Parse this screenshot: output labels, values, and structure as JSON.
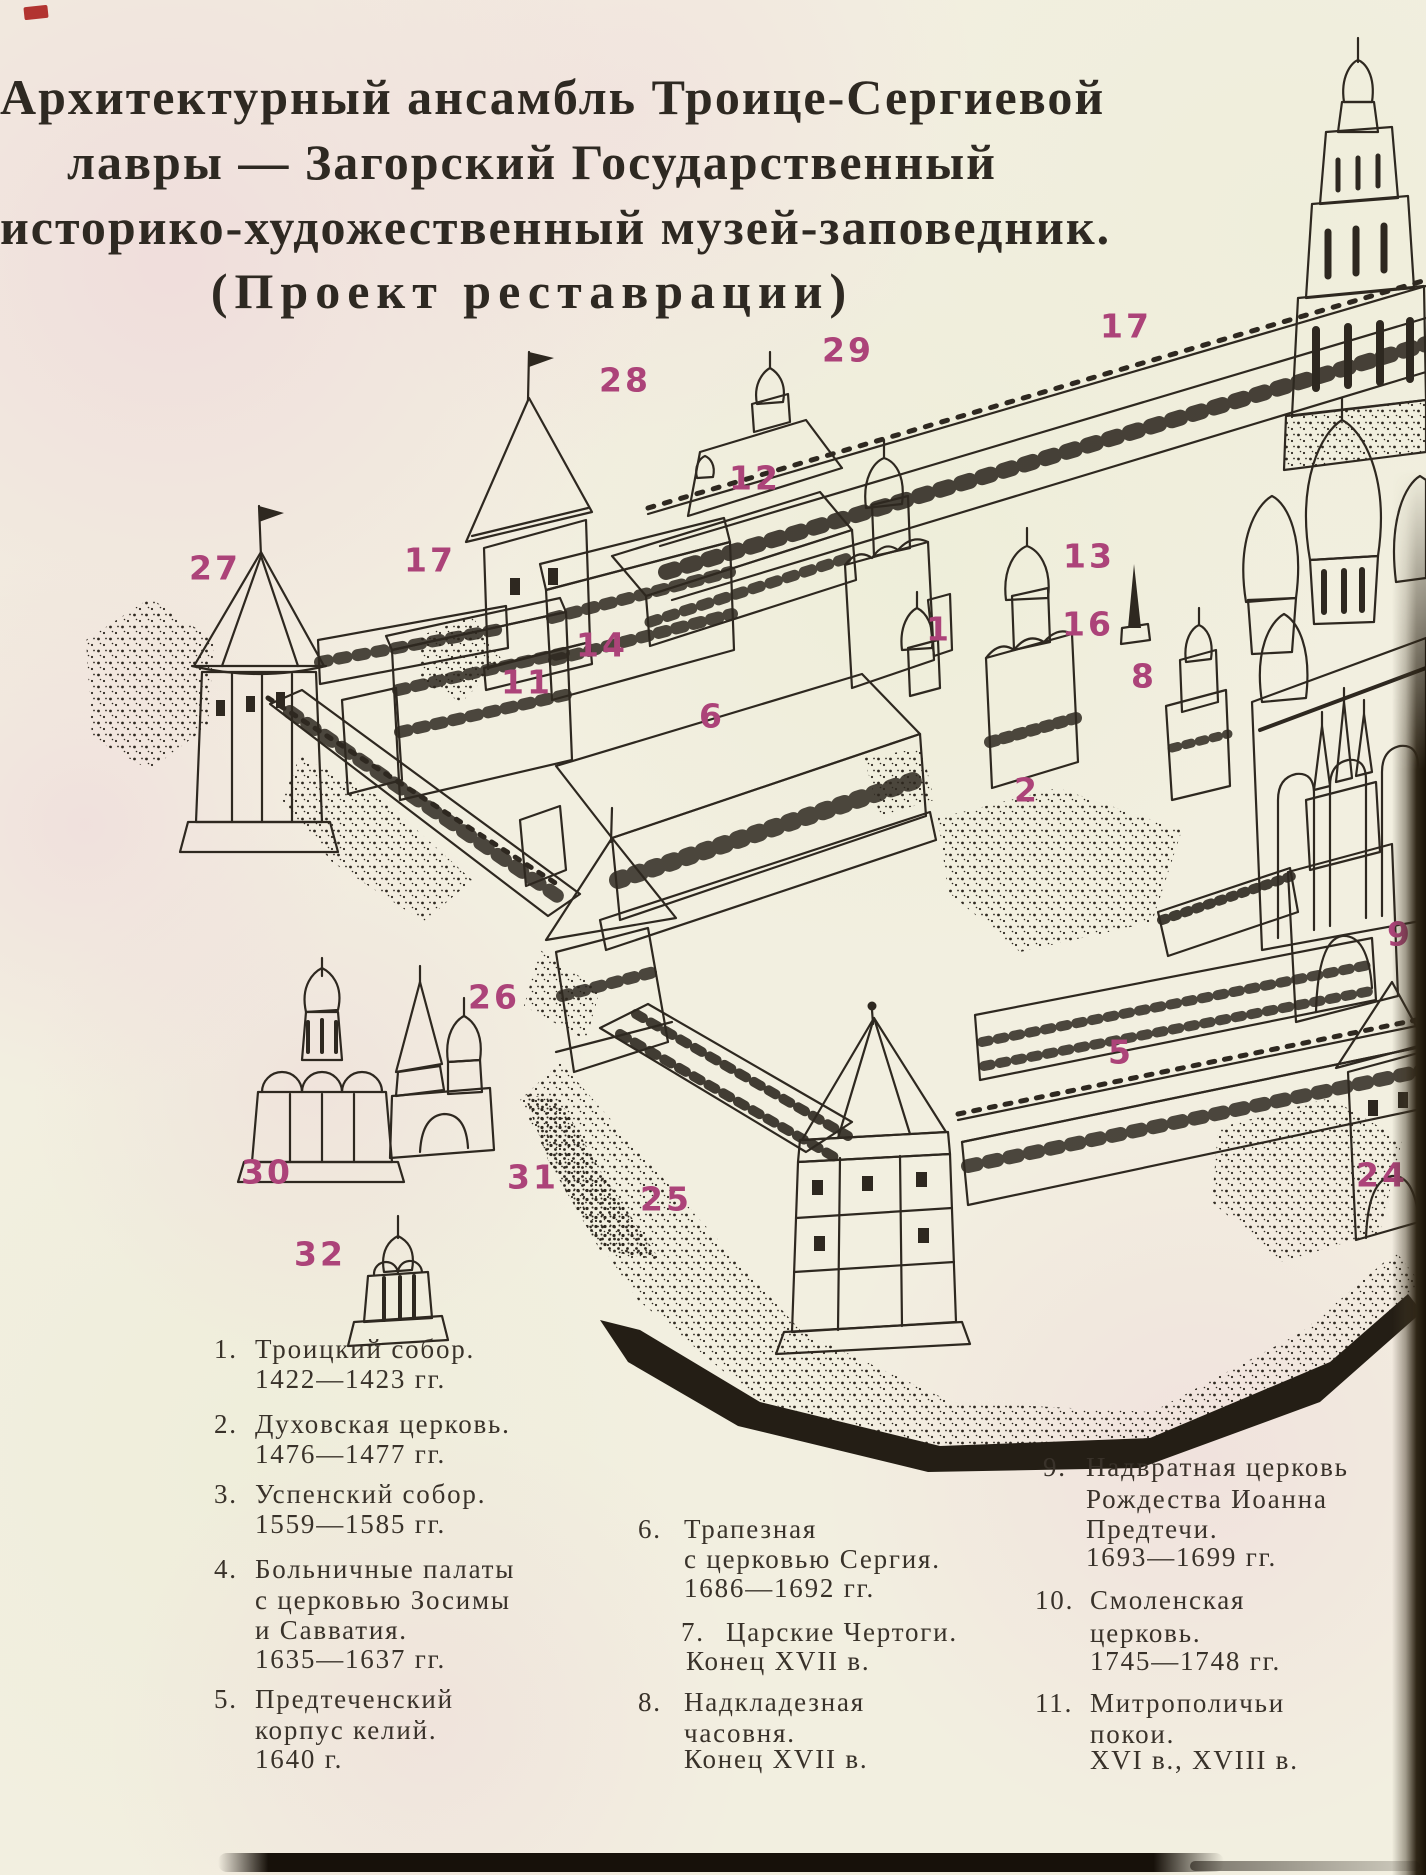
{
  "page": {
    "kind": "book page — restoration scheme of the Trinity Lavra of St. Sergius",
    "accent_color": "#ac4379",
    "ink_color": "#2e2820",
    "paper_color": "#f2efe0"
  },
  "title": {
    "lines": [
      {
        "text": "Архитектурный ансамбль Троице-Сергиевой",
        "y": 68
      },
      {
        "text": "лавры — Загорский Государственный",
        "y": 133
      },
      {
        "text": "историко-художественный музей-заповедник.",
        "y": 198
      },
      {
        "text": "(Проект реставрации)",
        "y": 262
      }
    ]
  },
  "plan_labels": [
    {
      "n": "27",
      "x": 215,
      "y": 568
    },
    {
      "n": "17",
      "x": 430,
      "y": 560
    },
    {
      "n": "28",
      "x": 625,
      "y": 380
    },
    {
      "n": "29",
      "x": 848,
      "y": 350
    },
    {
      "n": "17",
      "x": 1126,
      "y": 326
    },
    {
      "n": "12",
      "x": 755,
      "y": 478
    },
    {
      "n": "13",
      "x": 1089,
      "y": 556
    },
    {
      "n": "14",
      "x": 602,
      "y": 645
    },
    {
      "n": "11",
      "x": 527,
      "y": 682
    },
    {
      "n": "1",
      "x": 939,
      "y": 629
    },
    {
      "n": "16",
      "x": 1088,
      "y": 624
    },
    {
      "n": "8",
      "x": 1144,
      "y": 676
    },
    {
      "n": "6",
      "x": 712,
      "y": 716
    },
    {
      "n": "2",
      "x": 1027,
      "y": 790
    },
    {
      "n": "9",
      "x": 1400,
      "y": 934
    },
    {
      "n": "26",
      "x": 494,
      "y": 997
    },
    {
      "n": "5",
      "x": 1121,
      "y": 1052
    },
    {
      "n": "30",
      "x": 267,
      "y": 1172
    },
    {
      "n": "31",
      "x": 533,
      "y": 1177
    },
    {
      "n": "25",
      "x": 666,
      "y": 1199
    },
    {
      "n": "24",
      "x": 1382,
      "y": 1175
    },
    {
      "n": "32",
      "x": 320,
      "y": 1254
    }
  ],
  "legend": {
    "items": [
      {
        "number": "1.",
        "num_x": 214,
        "num_y": 1336,
        "lines": [
          {
            "text": "Троицкий собор.",
            "x": 255,
            "y": 1336
          },
          {
            "text": "1422—1423 гг.",
            "x": 255,
            "y": 1366
          }
        ]
      },
      {
        "number": "2.",
        "num_x": 214,
        "num_y": 1411,
        "lines": [
          {
            "text": "Духовская церковь.",
            "x": 255,
            "y": 1411
          },
          {
            "text": "1476—1477 гг.",
            "x": 255,
            "y": 1441
          }
        ]
      },
      {
        "number": "3.",
        "num_x": 214,
        "num_y": 1481,
        "lines": [
          {
            "text": "Успенский собор.",
            "x": 255,
            "y": 1481
          },
          {
            "text": "1559—1585 гг.",
            "x": 255,
            "y": 1511
          }
        ]
      },
      {
        "number": "4.",
        "num_x": 214,
        "num_y": 1556,
        "lines": [
          {
            "text": "Больничные палаты",
            "x": 255,
            "y": 1556
          },
          {
            "text": "с церковью Зосимы",
            "x": 255,
            "y": 1587
          },
          {
            "text": "и Савватия.",
            "x": 255,
            "y": 1617
          },
          {
            "text": "1635—1637 гг.",
            "x": 255,
            "y": 1646
          }
        ]
      },
      {
        "number": "5.",
        "num_x": 214,
        "num_y": 1686,
        "lines": [
          {
            "text": "Предтеченский",
            "x": 255,
            "y": 1686
          },
          {
            "text": "корпус келий.",
            "x": 255,
            "y": 1717
          },
          {
            "text": "1640 г.",
            "x": 255,
            "y": 1746
          }
        ]
      },
      {
        "number": "6.",
        "num_x": 638,
        "num_y": 1516,
        "lines": [
          {
            "text": "Трапезная",
            "x": 684,
            "y": 1516
          },
          {
            "text": "с церковью Сергия.",
            "x": 684,
            "y": 1546
          },
          {
            "text": "1686—1692 гг.",
            "x": 684,
            "y": 1575
          }
        ]
      },
      {
        "number": "7.",
        "num_x": 681,
        "num_y": 1619,
        "lines": [
          {
            "text": "Царские Чертоги.",
            "x": 726,
            "y": 1619
          },
          {
            "text": "Конец XVII в.",
            "x": 686,
            "y": 1648
          }
        ]
      },
      {
        "number": "8.",
        "num_x": 638,
        "num_y": 1689,
        "lines": [
          {
            "text": "Надкладезная",
            "x": 684,
            "y": 1689
          },
          {
            "text": "часовня.",
            "x": 684,
            "y": 1720
          },
          {
            "text": "Конец XVII в.",
            "x": 684,
            "y": 1746
          }
        ]
      },
      {
        "number": "9.",
        "num_x": 1043,
        "num_y": 1454,
        "lines": [
          {
            "text": "Надвратная церковь",
            "x": 1086,
            "y": 1454
          },
          {
            "text": "Рождества Иоанна",
            "x": 1086,
            "y": 1486
          },
          {
            "text": "Предтечи.",
            "x": 1086,
            "y": 1516
          },
          {
            "text": "1693—1699 гг.",
            "x": 1086,
            "y": 1544
          }
        ]
      },
      {
        "number": "10.",
        "num_x": 1035,
        "num_y": 1587,
        "lines": [
          {
            "text": "Смоленская",
            "x": 1090,
            "y": 1587
          },
          {
            "text": "церковь.",
            "x": 1090,
            "y": 1620
          },
          {
            "text": "1745—1748 гг.",
            "x": 1090,
            "y": 1648
          }
        ]
      },
      {
        "number": "11.",
        "num_x": 1035,
        "num_y": 1690,
        "lines": [
          {
            "text": "Митрополичьи",
            "x": 1090,
            "y": 1690
          },
          {
            "text": "покои.",
            "x": 1090,
            "y": 1721
          },
          {
            "text": "XVI в., XVIII в.",
            "x": 1090,
            "y": 1747
          }
        ]
      }
    ]
  }
}
